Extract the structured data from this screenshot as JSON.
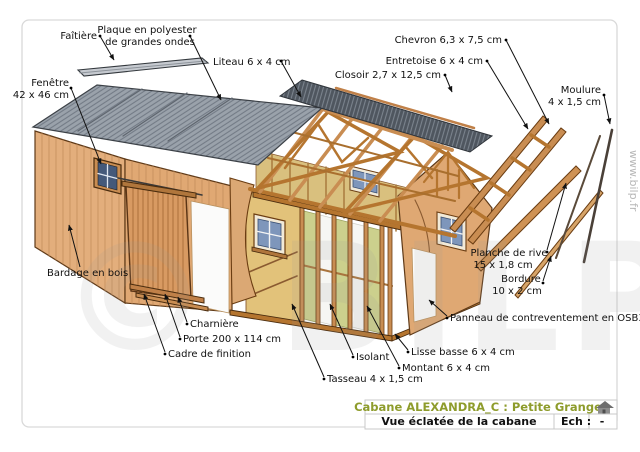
{
  "annotations": {
    "faitiere": {
      "text": "Faîtière"
    },
    "plaque_polyester": {
      "line1": "Plaque en polyester",
      "line2": "de grandes ondes"
    },
    "liteau": {
      "text": "Liteau 6 x 4 cm"
    },
    "fenetre": {
      "line1": "Fenêtre",
      "line2": "42 x 46 cm"
    },
    "chevron": {
      "text": "Chevron 6,3 x 7,5 cm"
    },
    "entretoise": {
      "text": "Entretoise 6 x 4 cm"
    },
    "closoir": {
      "text": "Closoir 2,7 x 12,5 cm"
    },
    "moulure": {
      "line1": "Moulure",
      "line2": "4 x 1,5 cm"
    },
    "bardage": {
      "text": "Bardage en bois"
    },
    "charniere": {
      "text": "Charnière"
    },
    "porte": {
      "text": "Porte 200 x 114 cm"
    },
    "cadre_finition": {
      "text": "Cadre de finition"
    },
    "tasseau": {
      "text": "Tasseau 4 x 1,5 cm"
    },
    "isolant": {
      "text": "Isolant"
    },
    "montant": {
      "text": "Montant 6 x 4 cm"
    },
    "lisse_basse": {
      "text": "Lisse basse 6 x 4 cm"
    },
    "panneau_osb": {
      "text": "Panneau de contreventement en OSB3"
    },
    "planche_rive": {
      "line1": "Planche de rive",
      "line2": "15 x 1,8 cm"
    },
    "bordure": {
      "line1": "Bordure",
      "line2": "10 x 2 cm"
    }
  },
  "title_block": {
    "title": "Cabane ALEXANDRA_C : Petite Grange",
    "subtitle": "Vue éclatée de la cabane",
    "scale_label": "Ech :",
    "scale_value": "-"
  },
  "watermark": {
    "logo": "© BILP",
    "url": "www.bilp.fr"
  },
  "colors": {
    "title_green": "#8e9c2c",
    "roof_gray": "#9aa2ab",
    "polyester_dark": "#4f565f",
    "wall_tan": "#e0a873",
    "door_wood": "#d89a62",
    "framing_wood": "#c98d52",
    "osb_yellow": "#e2c27a",
    "insulation_green": "#ccd08d",
    "label_ink": "#111111"
  }
}
